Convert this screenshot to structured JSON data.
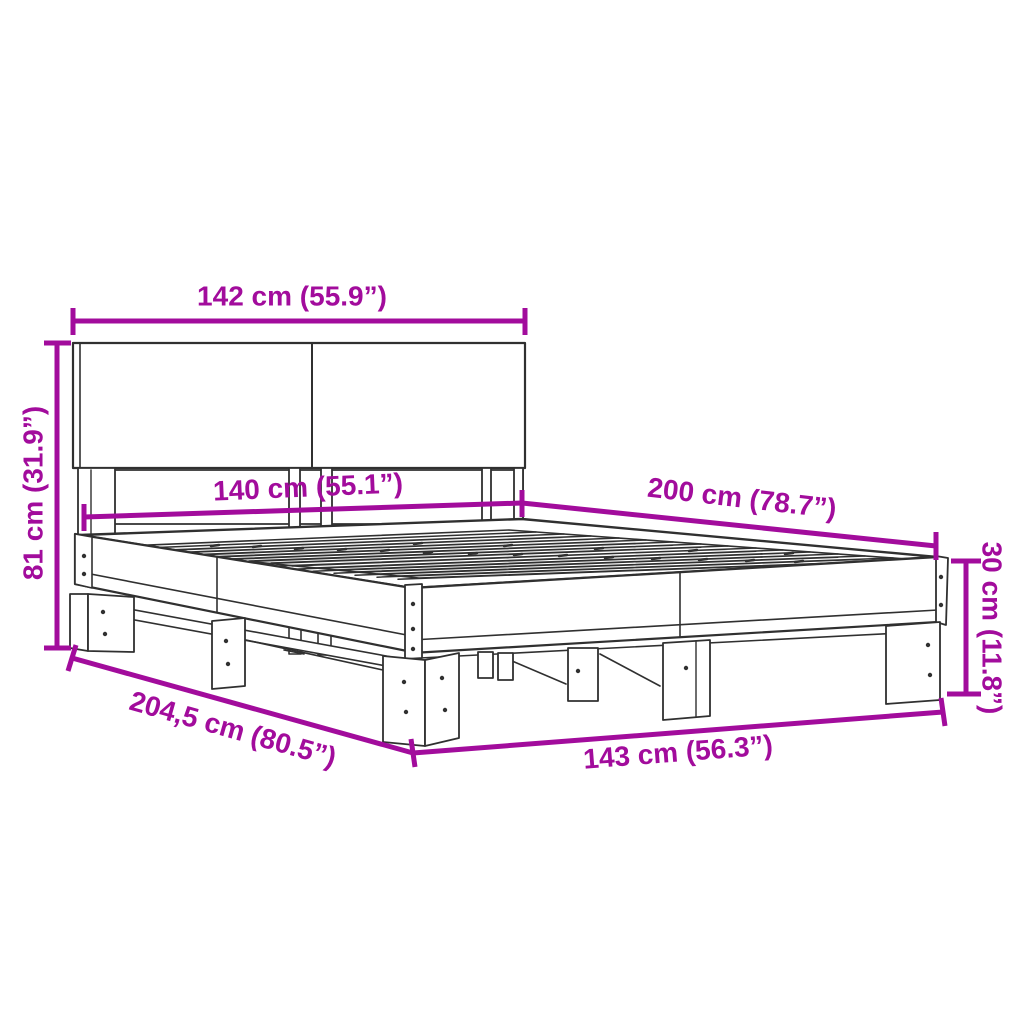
{
  "canvas": {
    "width": 1024,
    "height": 1024,
    "background": "#ffffff"
  },
  "colors": {
    "dimension_accent": "#A20C9C",
    "line_art": "#303030"
  },
  "diagram": {
    "subject": "bed-frame dimension drawing",
    "style": "black technical line art with magenta dimension arrows on white"
  },
  "dimensions": {
    "headboard_width": {
      "label": "142 cm (55.9”)"
    },
    "headboard_height": {
      "label": "81 cm (31.9”)"
    },
    "slat_area_width": {
      "label": "140 cm (55.1”)"
    },
    "bed_length": {
      "label": "200 cm (78.7”)"
    },
    "frame_height": {
      "label": "30 cm (11.8”)"
    },
    "total_length": {
      "label": "204,5 cm (80.5”)"
    },
    "total_width": {
      "label": "143 cm (56.3”)"
    }
  }
}
